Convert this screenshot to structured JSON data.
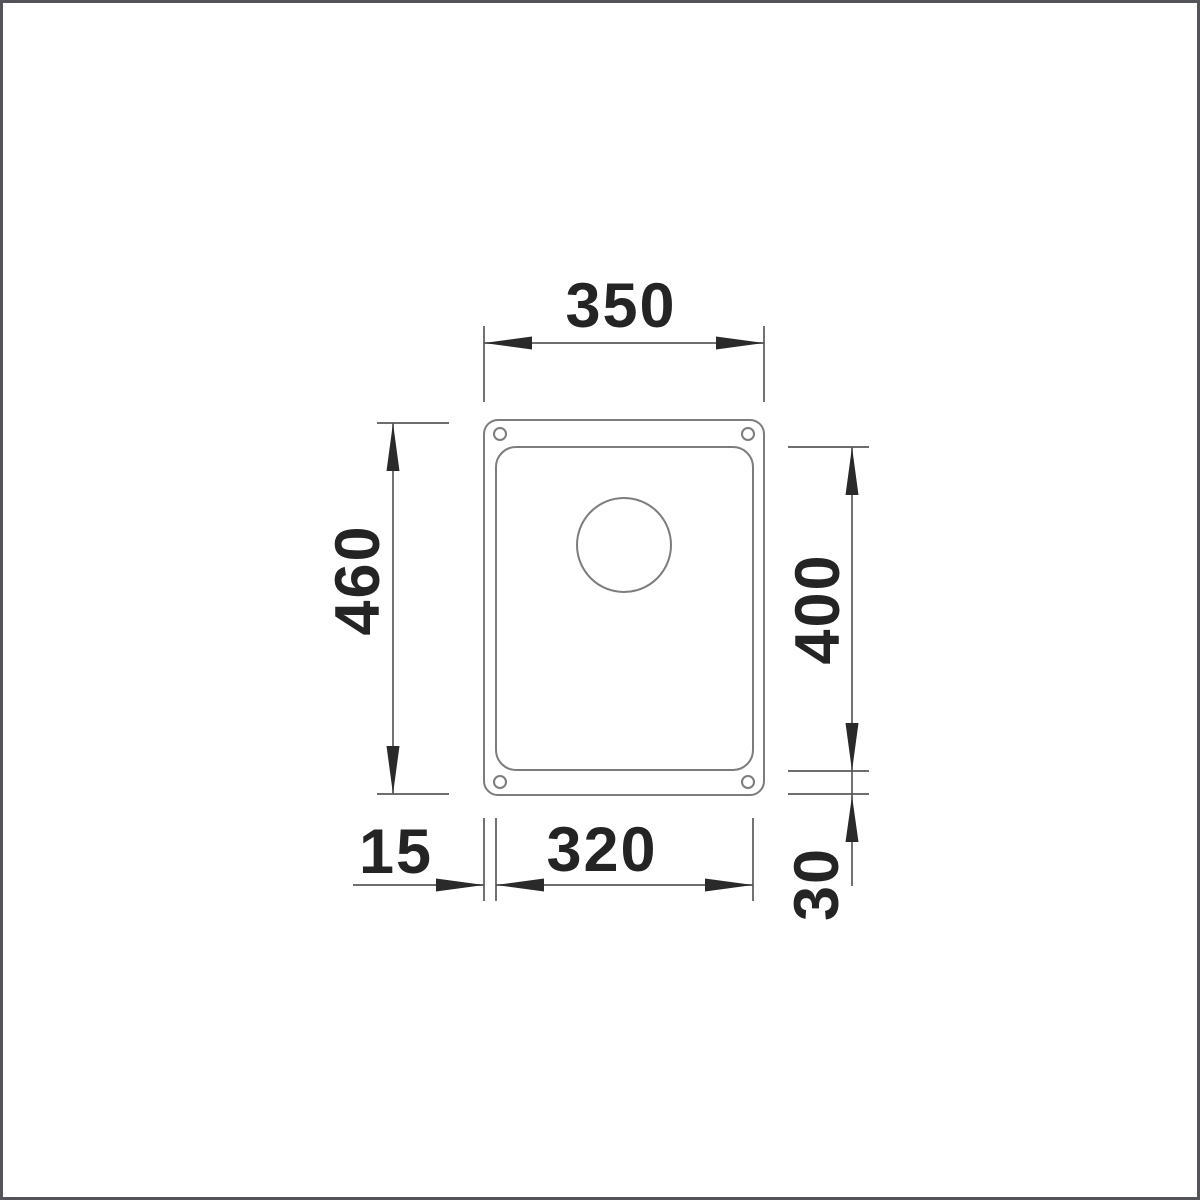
{
  "drawing": {
    "dimensions": {
      "overall_width": "350",
      "overall_height": "460",
      "bowl_height": "400",
      "bowl_width": "320",
      "rim_left": "15",
      "rim_bottom": "30"
    },
    "colors": {
      "background": "#ffffff",
      "frame_border": "#54555a",
      "sink_outline": "#7d7d7d",
      "dimension_line": "#5a5a5a",
      "arrow_and_text": "#242424"
    }
  }
}
